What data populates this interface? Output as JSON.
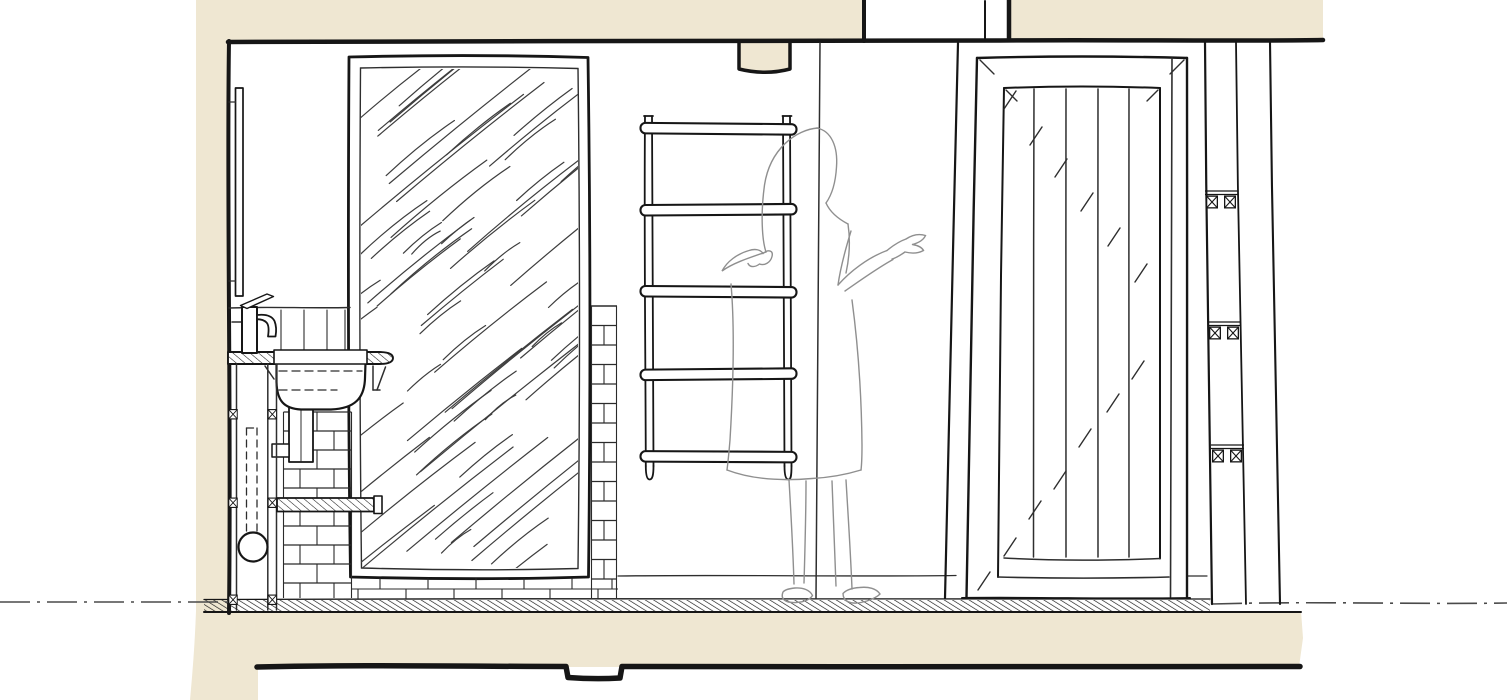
{
  "canvas": {
    "width": 1507,
    "height": 700
  },
  "palette": {
    "paper": "#ffffff",
    "wall_poche": "#efe7d2",
    "ink": "#161616",
    "line": "#2e2e2e",
    "light_line": "#4a4a4a",
    "figure_outline": "#8f8f8f"
  },
  "scene": {
    "type": "hand-drawn architectural interior elevation, bathroom wall section",
    "elements": [
      {
        "name": "wall-section-poche",
        "desc": "beige poche of cut walls, ceiling and floor slab"
      },
      {
        "name": "ceiling-beam",
        "desc": "downstand beam notch in ceiling section"
      },
      {
        "name": "mirror",
        "desc": "large framed mirror panel with diagonal glass hatching"
      },
      {
        "name": "washbasin",
        "desc": "semi-recessed basin set in sectioned countertop with dashed hidden bowl lines and trap"
      },
      {
        "name": "basin-tap",
        "desc": "single lever mixer tap on counter"
      },
      {
        "name": "tiled-wall",
        "desc": "tiled splashback and brick courses beside and under mirror"
      },
      {
        "name": "wall-shelf",
        "desc": "sectioned shelf with hatched profile and end cap"
      },
      {
        "name": "service-chase",
        "desc": "pipe chase with crossed batten markers, dashed pipe run and round duct"
      },
      {
        "name": "towel-ladder",
        "desc": "five-rung ladder style towel rail"
      },
      {
        "name": "person-figure",
        "desc": "faint sketch figure standing with one hand raised"
      },
      {
        "name": "planked-door",
        "desc": "framed vertical board door with mitre and reflection tick marks"
      },
      {
        "name": "stud-wall",
        "desc": "stud wall section lines with crossed batten pairs"
      },
      {
        "name": "floor-band",
        "desc": "hatched floor screed band over floor slab"
      },
      {
        "name": "datum-centerline",
        "desc": "dash-dot datum line at floor level"
      }
    ]
  }
}
